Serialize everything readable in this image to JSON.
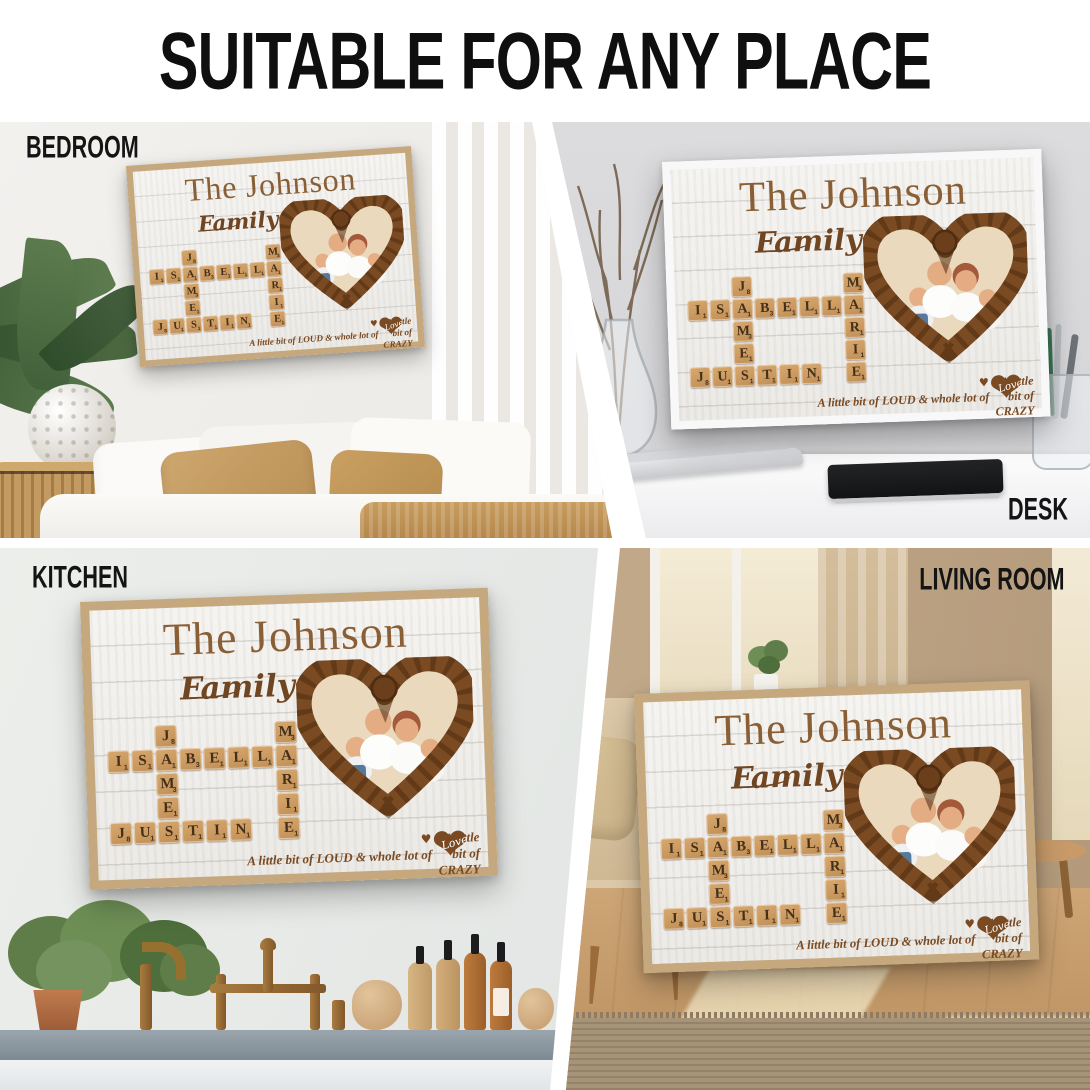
{
  "header": {
    "title": "SUITABLE FOR ANY PLACE"
  },
  "scenes": [
    {
      "id": "bedroom",
      "label": "BEDROOM"
    },
    {
      "id": "desk",
      "label": "DESK"
    },
    {
      "id": "kitchen",
      "label": "KITCHEN"
    },
    {
      "id": "living-room",
      "label": "LIVING ROOM"
    }
  ],
  "poster": {
    "title": "The Johnson",
    "subtitle": "Family",
    "names": [
      "ISABELLA",
      "JAMES",
      "JUSTIN",
      "MARIE"
    ],
    "tagline_line1": "A little bit of CRAZY",
    "tagline_line2": "A little bit of LOUD & whole lot of",
    "love_word": "Love",
    "icons": {
      "small_heart": "♥",
      "love_heart": "❤"
    },
    "crossword": {
      "grid": {
        "cols": 8,
        "rows": 5
      },
      "tiles": [
        {
          "row": 1,
          "col": 3,
          "letter": "J",
          "value": 8
        },
        {
          "row": 1,
          "col": 8,
          "letter": "M",
          "value": 3
        },
        {
          "row": 2,
          "col": 1,
          "letter": "I",
          "value": 1
        },
        {
          "row": 2,
          "col": 2,
          "letter": "S",
          "value": 1
        },
        {
          "row": 2,
          "col": 3,
          "letter": "A",
          "value": 1
        },
        {
          "row": 2,
          "col": 4,
          "letter": "B",
          "value": 3
        },
        {
          "row": 2,
          "col": 5,
          "letter": "E",
          "value": 1
        },
        {
          "row": 2,
          "col": 6,
          "letter": "L",
          "value": 1
        },
        {
          "row": 2,
          "col": 7,
          "letter": "L",
          "value": 1
        },
        {
          "row": 2,
          "col": 8,
          "letter": "A",
          "value": 1
        },
        {
          "row": 3,
          "col": 3,
          "letter": "M",
          "value": 3
        },
        {
          "row": 3,
          "col": 8,
          "letter": "R",
          "value": 1
        },
        {
          "row": 4,
          "col": 3,
          "letter": "E",
          "value": 1
        },
        {
          "row": 4,
          "col": 8,
          "letter": "I",
          "value": 1
        },
        {
          "row": 5,
          "col": 1,
          "letter": "J",
          "value": 8
        },
        {
          "row": 5,
          "col": 2,
          "letter": "U",
          "value": 1
        },
        {
          "row": 5,
          "col": 3,
          "letter": "S",
          "value": 1
        },
        {
          "row": 5,
          "col": 4,
          "letter": "T",
          "value": 1
        },
        {
          "row": 5,
          "col": 5,
          "letter": "I",
          "value": 1
        },
        {
          "row": 5,
          "col": 6,
          "letter": "N",
          "value": 1
        },
        {
          "row": 5,
          "col": 8,
          "letter": "E",
          "value": 1
        }
      ]
    },
    "colors": {
      "title_brown": "#8a5f35",
      "script_brown": "#6f4522",
      "rope_brown": "#7a4a22",
      "tile_tan": "#cb9a63",
      "tile_letter": "#44301a",
      "frame_tan": "#c6a87e",
      "frame_white": "#f8f8f8"
    }
  }
}
